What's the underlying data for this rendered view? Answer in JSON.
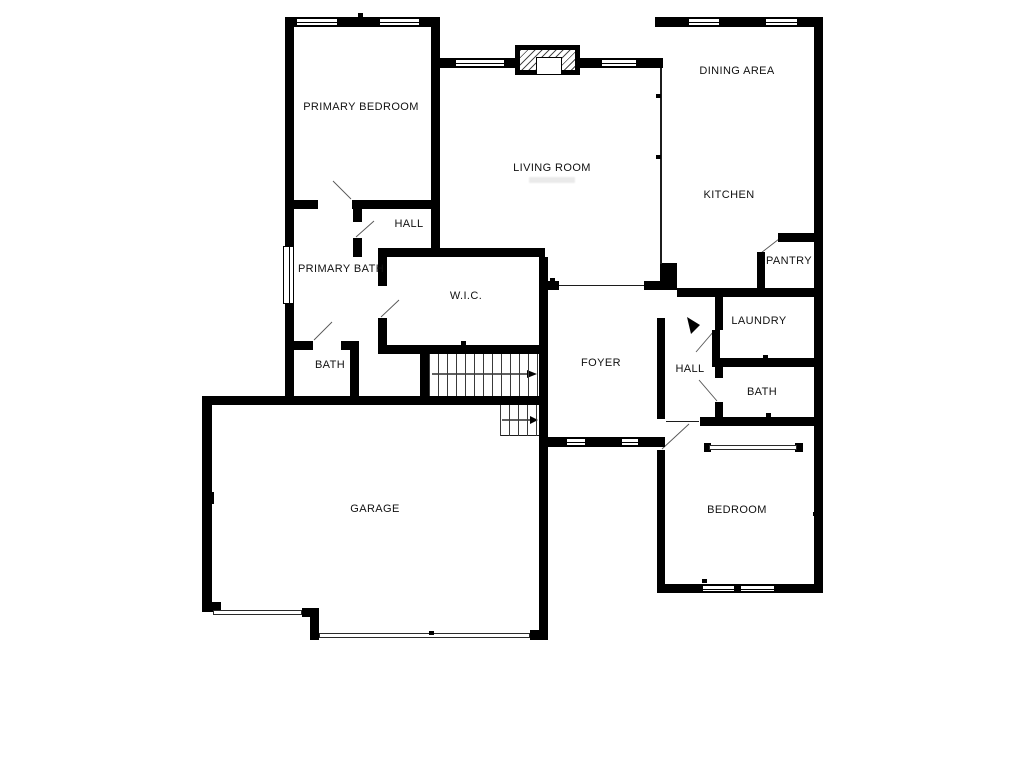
{
  "plan_title": "Floor Plan",
  "colors": {
    "walls": "#000000",
    "background": "#ffffff",
    "label_text": "#111111"
  },
  "rooms": [
    {
      "id": "primary-bedroom",
      "label": "PRIMARY BEDROOM",
      "x": 361,
      "y": 107
    },
    {
      "id": "living-room",
      "label": "LIVING ROOM",
      "x": 552,
      "y": 168
    },
    {
      "id": "dining-area",
      "label": "DINING AREA",
      "x": 737,
      "y": 71
    },
    {
      "id": "kitchen",
      "label": "KITCHEN",
      "x": 729,
      "y": 195
    },
    {
      "id": "hall-primary",
      "label": "HALL",
      "x": 409,
      "y": 224
    },
    {
      "id": "primary-bath",
      "label": "PRIMARY BATH",
      "x": 341,
      "y": 269
    },
    {
      "id": "wic",
      "label": "W.I.C.",
      "x": 466,
      "y": 296
    },
    {
      "id": "pantry",
      "label": "PANTRY",
      "x": 789,
      "y": 261
    },
    {
      "id": "laundry",
      "label": "LAUNDRY",
      "x": 759,
      "y": 321
    },
    {
      "id": "bath-left",
      "label": "BATH",
      "x": 330,
      "y": 365
    },
    {
      "id": "foyer",
      "label": "FOYER",
      "x": 601,
      "y": 363
    },
    {
      "id": "hall-right",
      "label": "HALL",
      "x": 690,
      "y": 369
    },
    {
      "id": "bath-right",
      "label": "BATH",
      "x": 762,
      "y": 392
    },
    {
      "id": "garage",
      "label": "GARAGE",
      "x": 375,
      "y": 509
    },
    {
      "id": "bedroom",
      "label": "BEDROOM",
      "x": 737,
      "y": 510
    }
  ],
  "features": {
    "fireplace": "fireplace",
    "staircase_main_direction": "right",
    "staircase_lower_direction": "right",
    "window_count": 11,
    "garage_door_count": 2
  }
}
